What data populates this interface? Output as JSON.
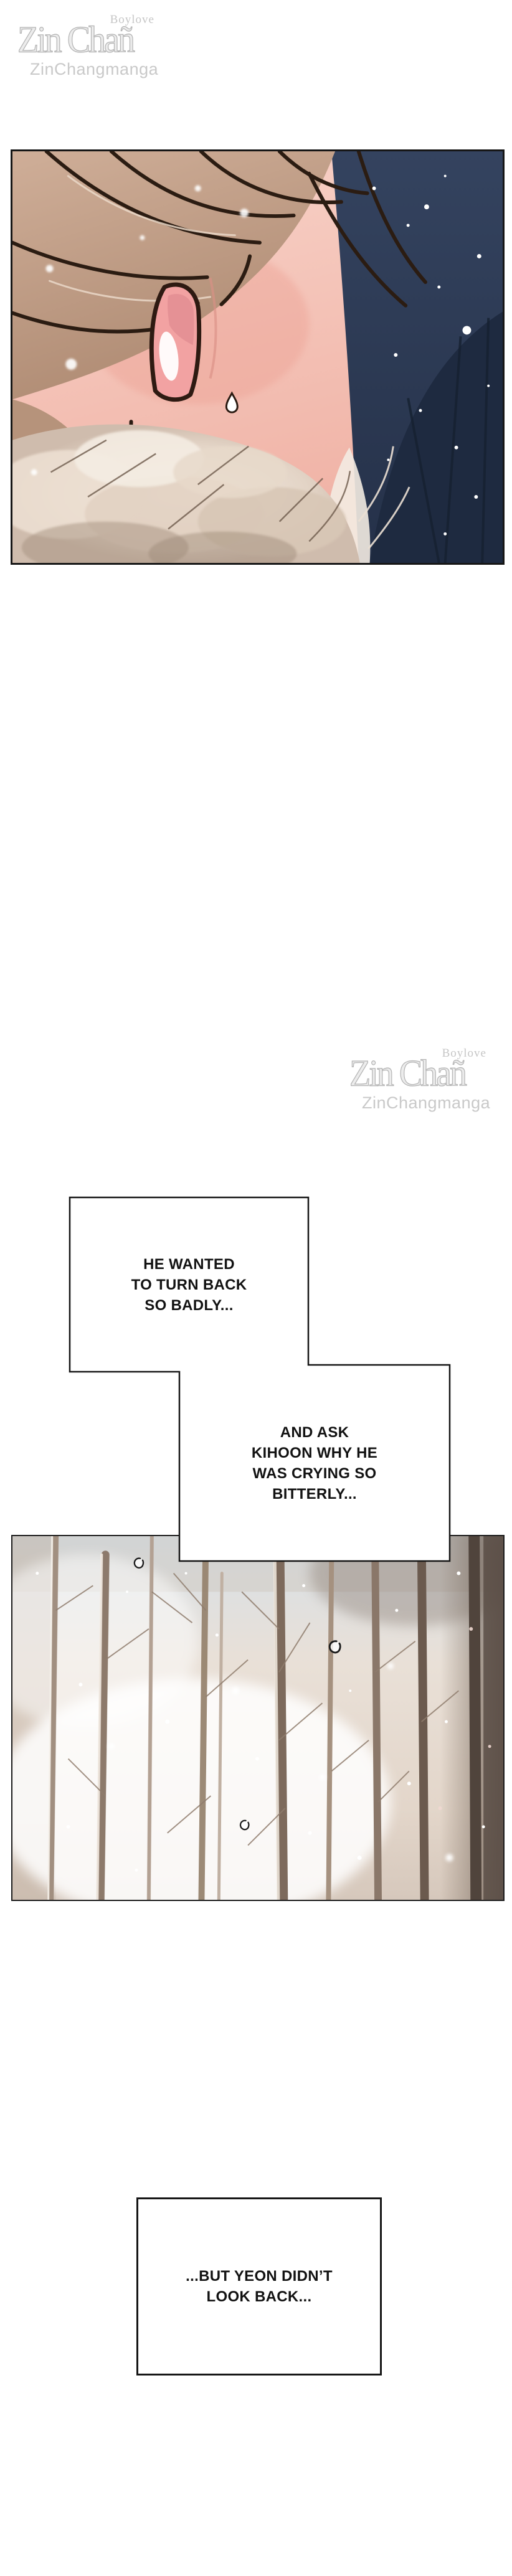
{
  "watermark": {
    "tagline": "Boylove",
    "brand": "Zin Chañ",
    "handle": "ZinChangmanga"
  },
  "narration": {
    "box1": {
      "lines": [
        "HE WANTED",
        "TO TURN BACK",
        "SO BADLY..."
      ]
    },
    "box2": {
      "lines": [
        "AND ASK",
        "KIHOON WHY HE",
        "WAS CRYING SO",
        "BITTERLY..."
      ]
    },
    "box3": {
      "lines": [
        "...BUT YEON DIDN’T",
        "LOOK BACK..."
      ]
    }
  },
  "palette": {
    "night_navy": "#2e3c57",
    "jacket_navy": "#1e2a40",
    "hair_tan": "#c3a18c",
    "skin_pink": "#f5c6bb",
    "mouth_pink": "#f2a2a2",
    "snow_white": "#ffffff",
    "forest_beige": "#e6dcd2",
    "sky_pale_blue": "#d7e0e7",
    "outline_black": "#1a1a1a",
    "watermark_gray": "#c6c6c6"
  }
}
